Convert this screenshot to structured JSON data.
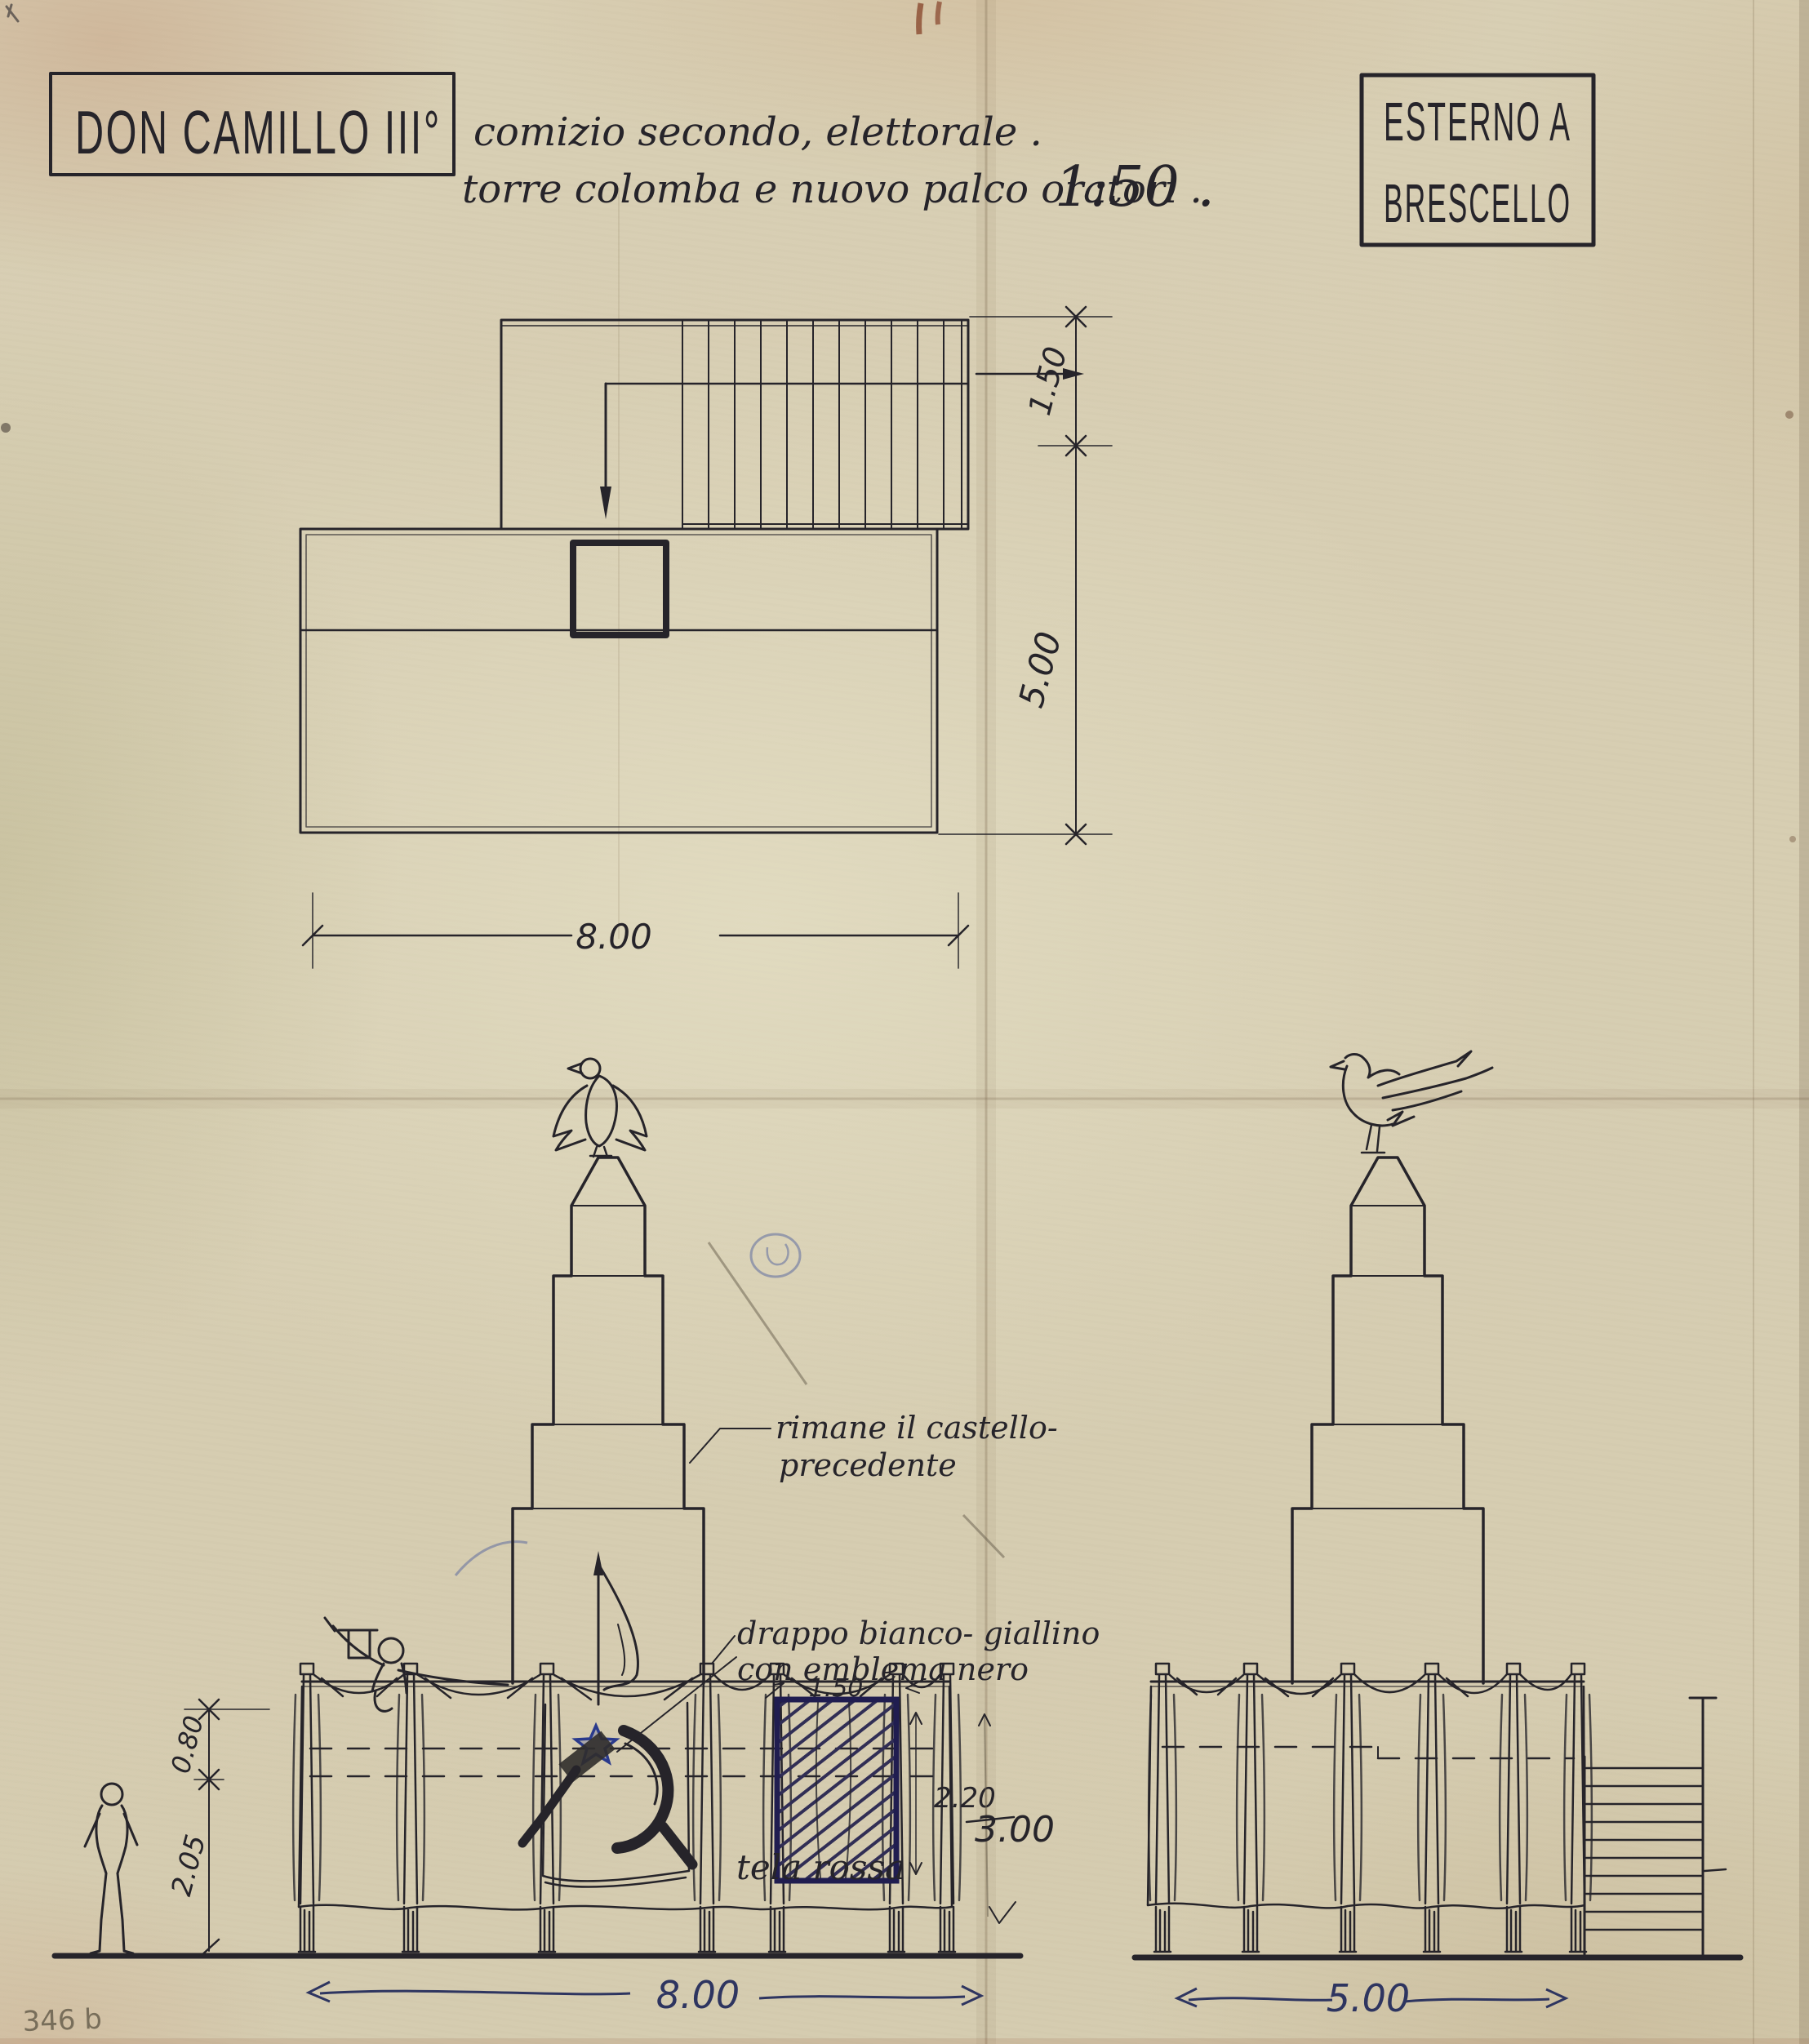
{
  "colors": {
    "paper": "#d8cfb4",
    "ink": "#26242a",
    "blue_ink": "#2e3560",
    "pencil": "#8a8070",
    "stain_red_brown": "#8a4a30"
  },
  "header": {
    "title": "DON CAMILLO III°",
    "subtitle_line1": "comizio secondo, elettorale .",
    "subtitle_line2": "torre colomba e nuovo palco oratori .",
    "scale_note": "1:50 .",
    "stamp_line1": "ESTERNO A",
    "stamp_line2": "BRESCELLO"
  },
  "plan_view": {
    "dim_stair_depth": "1.50",
    "dim_depth": "5.00",
    "dim_width": "8.00"
  },
  "front_elevation": {
    "note_tower_line1": "rimane il castello-",
    "note_tower_line2": "precedente",
    "note_banner_line1": "drappo bianco- giallino",
    "note_banner_line2": "con emblema nero",
    "note_skirt": "tela rossa",
    "dim_parapet": "0.80",
    "dim_stage_height": "2.05",
    "dim_drape_width": "1.50",
    "dim_drape_height": "2.20",
    "dim_overall_height": "3.00",
    "dim_width": "8.00"
  },
  "side_elevation": {
    "dim_width": "5.00"
  },
  "footer": {
    "corner_mark": "346 b"
  }
}
